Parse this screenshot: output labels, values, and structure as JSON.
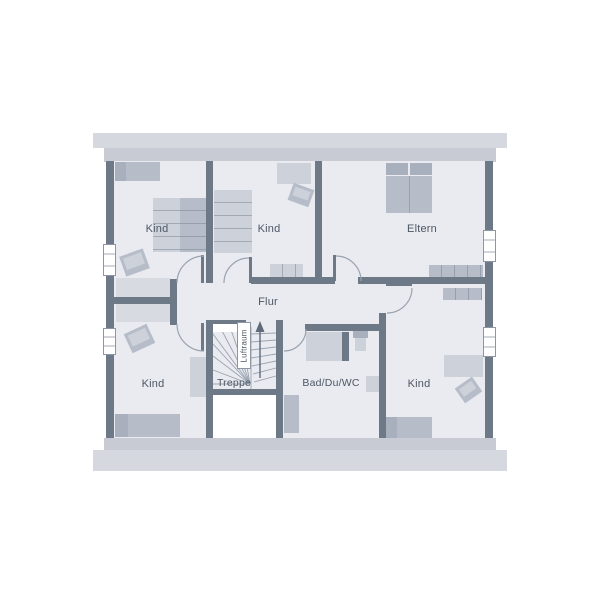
{
  "palette": {
    "wall": "#6e7987",
    "floor": "#e9ebf0",
    "bar1": "#d5d8de",
    "bar2": "#c8cbd3",
    "f1": "#b6bdc9",
    "f2": "#a9b0bd",
    "f3": "#cdd2da",
    "f4": "#d7dae1",
    "line": "#9aa3b0",
    "text": "#4d5765",
    "frame": "#8d96a4",
    "arrow": "#5f6b7a"
  },
  "floorplan": {
    "rooms": {
      "kind_top_left": "Kind",
      "kind_top_middle": "Kind",
      "eltern": "Eltern",
      "flur": "Flur",
      "kind_bottom_left": "Kind",
      "treppe": "Treppe",
      "bad": "Bad/Du/WC",
      "kind_bottom_right": "Kind",
      "luftraum": "Luftraum"
    }
  }
}
